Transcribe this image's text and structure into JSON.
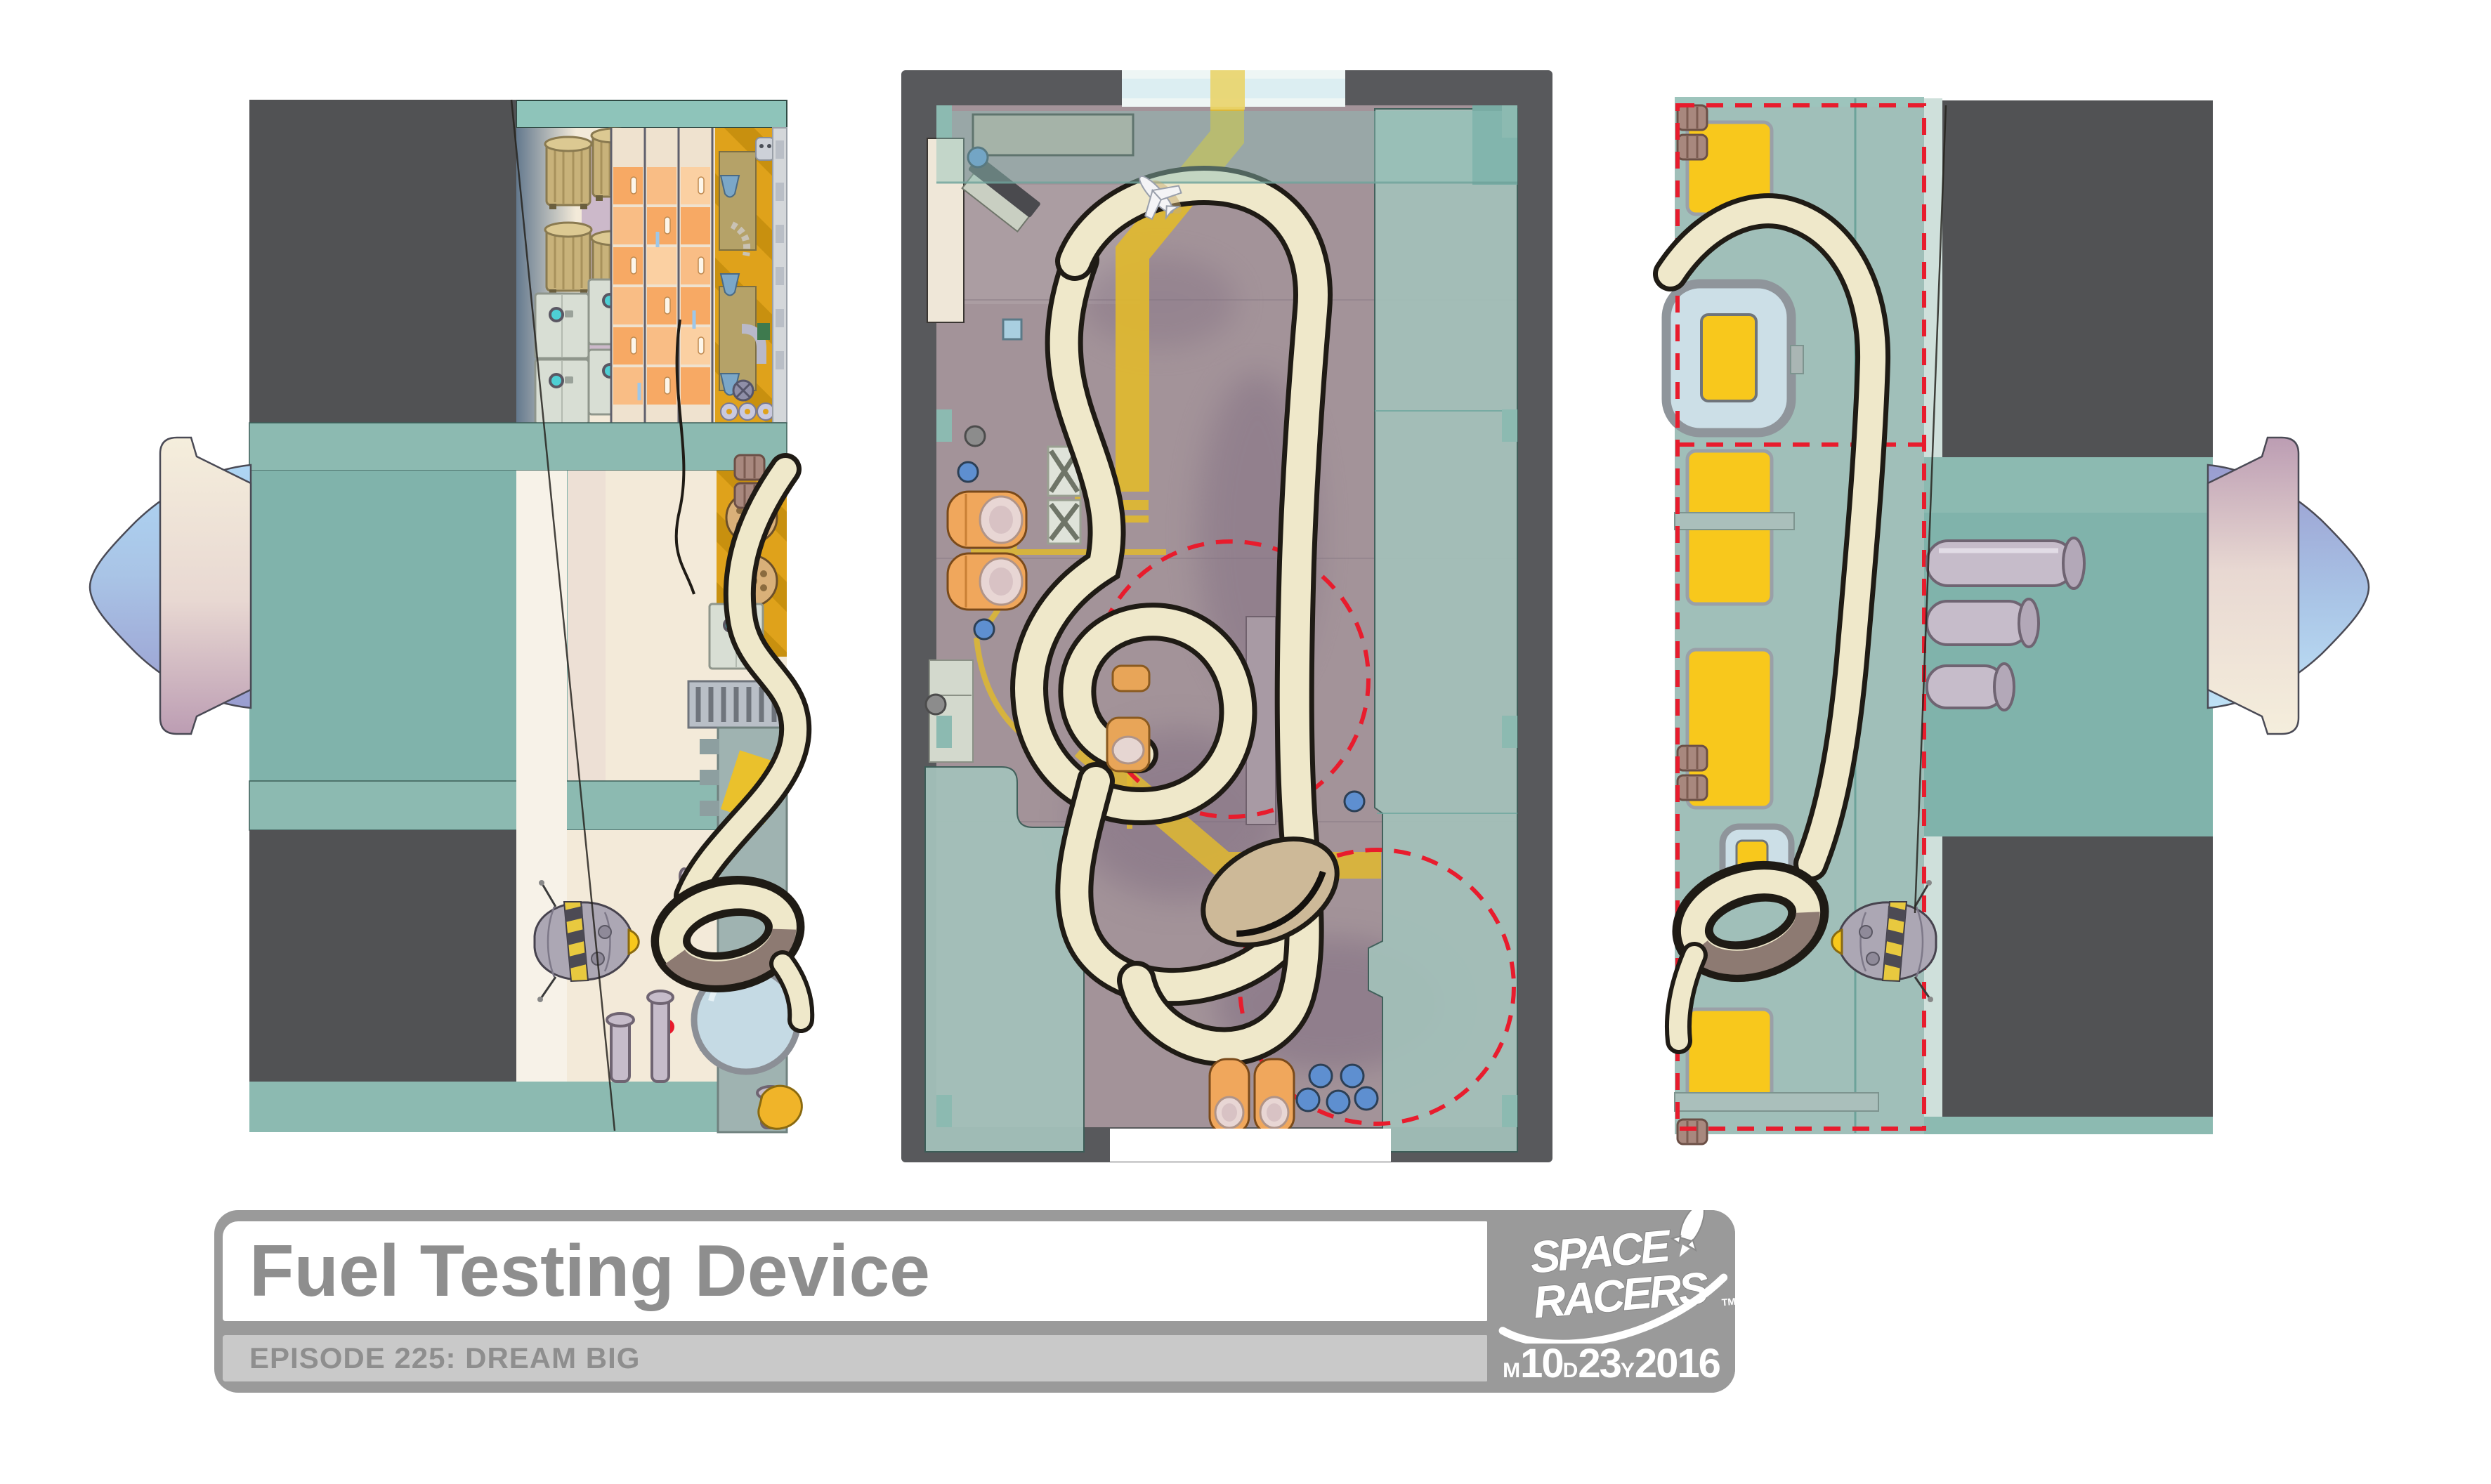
{
  "title_block": {
    "title": "Fuel Testing Device",
    "episode": "EPISODE 225: DREAM BIG",
    "logo": {
      "line1": "SPACE",
      "line2": "RACERS",
      "trademark": "TM"
    },
    "date": {
      "month_label": "M",
      "month_value": "10",
      "day_label": "D",
      "day_value": "23",
      "year_label": "Y",
      "year_value": "2016"
    }
  },
  "colors": {
    "teal_band": "#8cbab1",
    "teal_band_light": "#8ec4ba",
    "teal_field": "#80b3ab",
    "teal_overlay": "#a3c1ba",
    "teal_column": "#a0bfb9",
    "dark_slab": "#515254",
    "wall_gray": "#58595c",
    "floor_mauve": "#a39399",
    "floor_shadow": "#7e6b80",
    "beige": "#f3ead9",
    "gold": "#dfa21b",
    "gold_stripe": "#c8900f",
    "yellow_bright": "#f8c81c",
    "yellow_path": "#e0b92f",
    "locker_orange": "#f7a964",
    "locker_orange_light": "#f9bd85",
    "ribbon_cream": "#efe8ca",
    "ribbon_outline": "#1f1b15",
    "ribbon_brown": "#8d7a72",
    "bean_tan": "#cdb998",
    "blue_dot": "#5e8fd0",
    "red_dash": "#e81c2d",
    "pipe_lavender": "#c6bcca",
    "robot_gray": "#aca7b4",
    "hazard_yellow": "#e8c93f",
    "hazard_dark": "#4c4a54",
    "dome_blue": "#aed6f4",
    "dome_purple": "#9a9dd0",
    "collar_cream": "#f5eedc",
    "collar_mauve": "#bc9db3",
    "window_glass": "#ccdfe7",
    "block_gray": "#9a9a9a",
    "bar_gray": "#c9c9c9",
    "title_gray": "#8e8e8e"
  }
}
